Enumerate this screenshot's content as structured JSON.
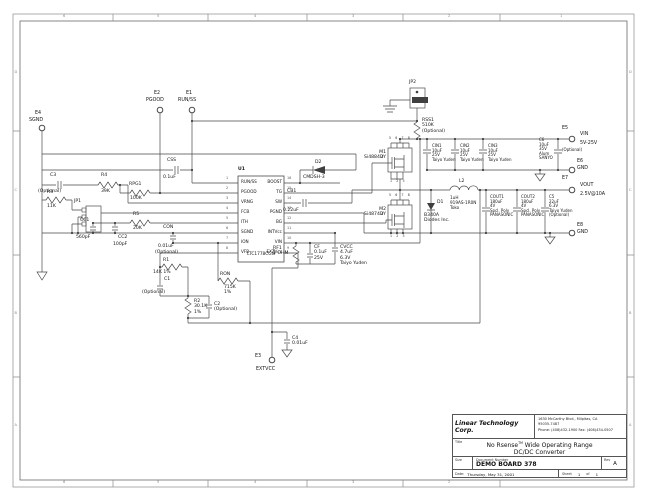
{
  "colors": {
    "background": "#ffffff",
    "line": "#4a4a4a",
    "text": "#161616"
  },
  "zones": {
    "cols": [
      "6",
      "5",
      "4",
      "3",
      "2",
      "1"
    ],
    "rows": [
      "D",
      "C",
      "B",
      "A"
    ]
  },
  "ic": {
    "ref": "U1",
    "part": "LTC1778CGN",
    "left_pins": [
      {
        "num": "1",
        "name": "RUN/SS"
      },
      {
        "num": "2",
        "name": "PGOOD"
      },
      {
        "num": "3",
        "name": "VRNG"
      },
      {
        "num": "4",
        "name": "FCB"
      },
      {
        "num": "5",
        "name": "ITH"
      },
      {
        "num": "6",
        "name": "SGND"
      },
      {
        "num": "7",
        "name": "ION"
      },
      {
        "num": "8",
        "name": "VFB"
      }
    ],
    "right_pins": [
      {
        "num": "16",
        "name": "BOOST"
      },
      {
        "num": "15",
        "name": "TG"
      },
      {
        "num": "14",
        "name": "SW"
      },
      {
        "num": "13",
        "name": "PGND"
      },
      {
        "num": "12",
        "name": "BG"
      },
      {
        "num": "11",
        "name": "INTVcc"
      },
      {
        "num": "10",
        "name": "VIN"
      },
      {
        "num": "9",
        "name": "EXTVcc"
      }
    ]
  },
  "terminals": {
    "e1": {
      "ref": "E1",
      "name": "RUN/SS"
    },
    "e2": {
      "ref": "E2",
      "name": "PGOOD"
    },
    "e3": {
      "ref": "E3",
      "name": "EXTVCC"
    },
    "e4": {
      "ref": "E4",
      "name": "SGND"
    },
    "e5": {
      "ref": "E5",
      "name": "VIN",
      "desc": "5V-25V"
    },
    "e6": {
      "ref": "E6",
      "name": "GND"
    },
    "e7": {
      "ref": "E7",
      "name": "VOUT",
      "desc": "2.5V@10A"
    },
    "e8": {
      "ref": "E8",
      "name": "GND"
    }
  },
  "components": {
    "c3": {
      "ref": "C3",
      "val": "(Optional)"
    },
    "r4": {
      "ref": "R4",
      "val": "39K"
    },
    "r3": {
      "ref": "R3",
      "val": "11K"
    },
    "jp1": {
      "ref": "JP1"
    },
    "rpg1": {
      "ref": "RPG1",
      "val": "100K"
    },
    "r5": {
      "ref": "R5",
      "val": "20K"
    },
    "cc1": {
      "ref": "CC1",
      "val": "560pF"
    },
    "cc2": {
      "ref": "CC2",
      "val": "100pF"
    },
    "con": {
      "ref": "CON",
      "val": "0.01uF",
      "note": "(Optional)"
    },
    "css": {
      "ref": "CSS",
      "val": "0.1uF"
    },
    "r1": {
      "ref": "R1",
      "val": "14K  1%"
    },
    "c1": {
      "ref": "C1",
      "val": "(Optional)"
    },
    "r2": {
      "lines": [
        "R2",
        "30.1K",
        "1%"
      ]
    },
    "c2": {
      "lines": [
        "C2",
        "(Optional)"
      ]
    },
    "ron": {
      "ref": "RON",
      "lines": [
        "715K",
        "1%"
      ]
    },
    "c4": {
      "lines": [
        "C4",
        "0.01uF"
      ]
    },
    "cb1": {
      "ref": "CB1",
      "val": "0.22uF"
    },
    "d2": {
      "ref": "D2",
      "val": "CMDSH-3"
    },
    "rf1": {
      "lines": [
        "RF1",
        "1 OHM"
      ]
    },
    "cf": {
      "lines": [
        "CF",
        "0.1uF",
        "25V"
      ]
    },
    "cvcc": {
      "lines": [
        "CVCC",
        "4.7uF",
        "6.3V",
        "Taiyo Yuden"
      ]
    },
    "jp2": {
      "ref": "JP2"
    },
    "rss1": {
      "lines": [
        "RSS1",
        "510K",
        "(Optional)"
      ]
    },
    "m1": {
      "lines": [
        "M1",
        "Si4884DY"
      ],
      "pins_top": "5 6 7 8",
      "pins_bottom": "1 2 3",
      "gate_pin": "4"
    },
    "m2": {
      "lines": [
        "M2",
        "Si4874DY"
      ],
      "pins_top": "5 6 7 8",
      "pins_bottom": "1 2 3",
      "gate_pin": "4"
    },
    "d1": {
      "ref": "D1",
      "lines": [
        "B340A",
        "Diodes Inc."
      ]
    },
    "l2": {
      "ref": "L2",
      "lines": [
        "1uH",
        "919AS-1R0N",
        "Toko"
      ]
    },
    "cin1": {
      "lines": [
        "CIN1",
        "10uF",
        "25V",
        "Taiyo Yuden"
      ]
    },
    "cin2": {
      "lines": [
        "CIN2",
        "10uF",
        "25V",
        "Taiyo Yuden"
      ]
    },
    "cin3": {
      "lines": [
        "CIN3",
        "10uF",
        "25V",
        "Taiyo Yuden"
      ]
    },
    "c6": {
      "lines": [
        "C6",
        "10uF",
        "35V",
        "Alum",
        "SANYO"
      ],
      "note": "(Optional)"
    },
    "cout1": {
      "lines": [
        "COUT1",
        "180uF",
        "4V",
        "Spcl. Poly",
        "PANASONIC"
      ]
    },
    "cout2": {
      "lines": [
        "COUT2",
        "180uF",
        "4V",
        "Spcl. Poly",
        "PANASONIC"
      ]
    },
    "c5": {
      "lines": [
        "C5",
        "22uF",
        "6.3V",
        "Taiyo Yuden",
        "(Optional)"
      ]
    }
  },
  "title_block": {
    "company": "Linear Technology Corp.",
    "address": [
      "1630 McCarthy Blvd., Milpitas, CA",
      "95035-7487",
      "Phone: (408)432-1900 Fax: (408)434-0507"
    ],
    "title_label": "Title",
    "title_pre": "No Rsense",
    "title_tm": "TM",
    "title_post": " Wide Operating Range",
    "title_line2": "DC/DC Converter",
    "size_label": "Size",
    "doc_label": "Document Number",
    "doc_number": "DEMO BOARD 378",
    "rev_label": "Rev",
    "rev": "A",
    "date_label": "Date:",
    "date": "Thursday, May 31, 2001",
    "sheet_label": "Sheet",
    "sheet_num": "1",
    "of_label": "of",
    "sheet_total": "1"
  }
}
